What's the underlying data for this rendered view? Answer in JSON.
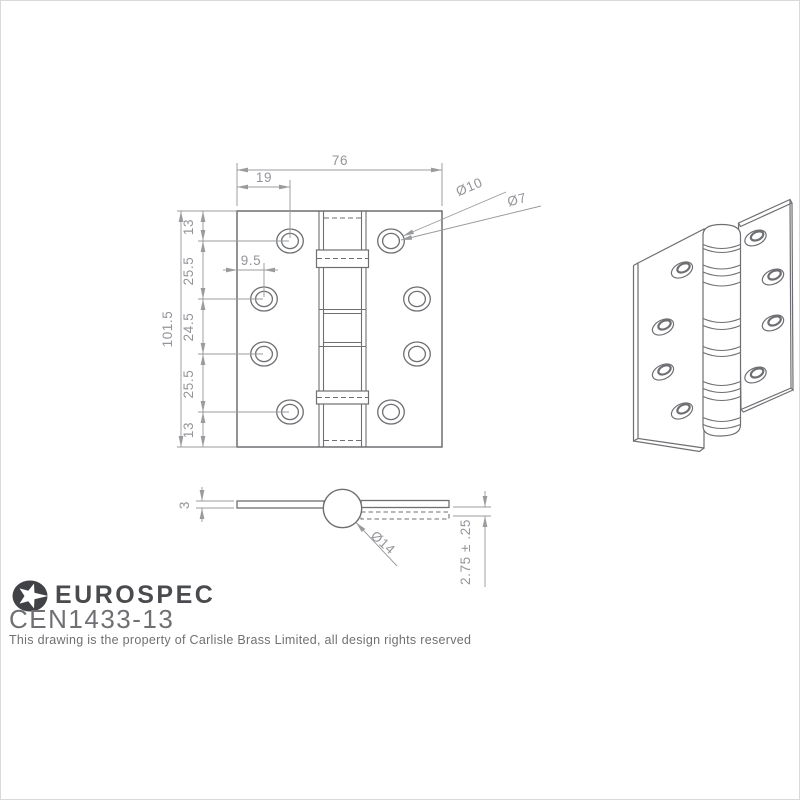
{
  "front_view": {
    "width": "76",
    "hole_offset_top": "19",
    "countersink_dia": "Ø10",
    "hole_dia": "Ø7",
    "height": "101.5",
    "seg_top": "13",
    "seg_upper": "25.5",
    "seg_middle": "24.5",
    "seg_lower": "25.5",
    "seg_bottom": "13",
    "hole_edge_offset": "9.5"
  },
  "section_view": {
    "leaf_thickness": "3",
    "knuckle_dia": "Ø14",
    "gap_tolerance": "2.75 ± .25"
  },
  "footer": {
    "brand": "EUROSPEC",
    "product_code": "CEN1433-13",
    "copyright": "This drawing is the property of Carlisle Brass Limited, all design rights reserved"
  },
  "colors": {
    "object_line": "#6e6f72",
    "dimension_line": "#9a9b9d",
    "dimension_text": "#94959a",
    "brand_dark": "#4a4b4e",
    "text_gray": "#6f7073"
  }
}
